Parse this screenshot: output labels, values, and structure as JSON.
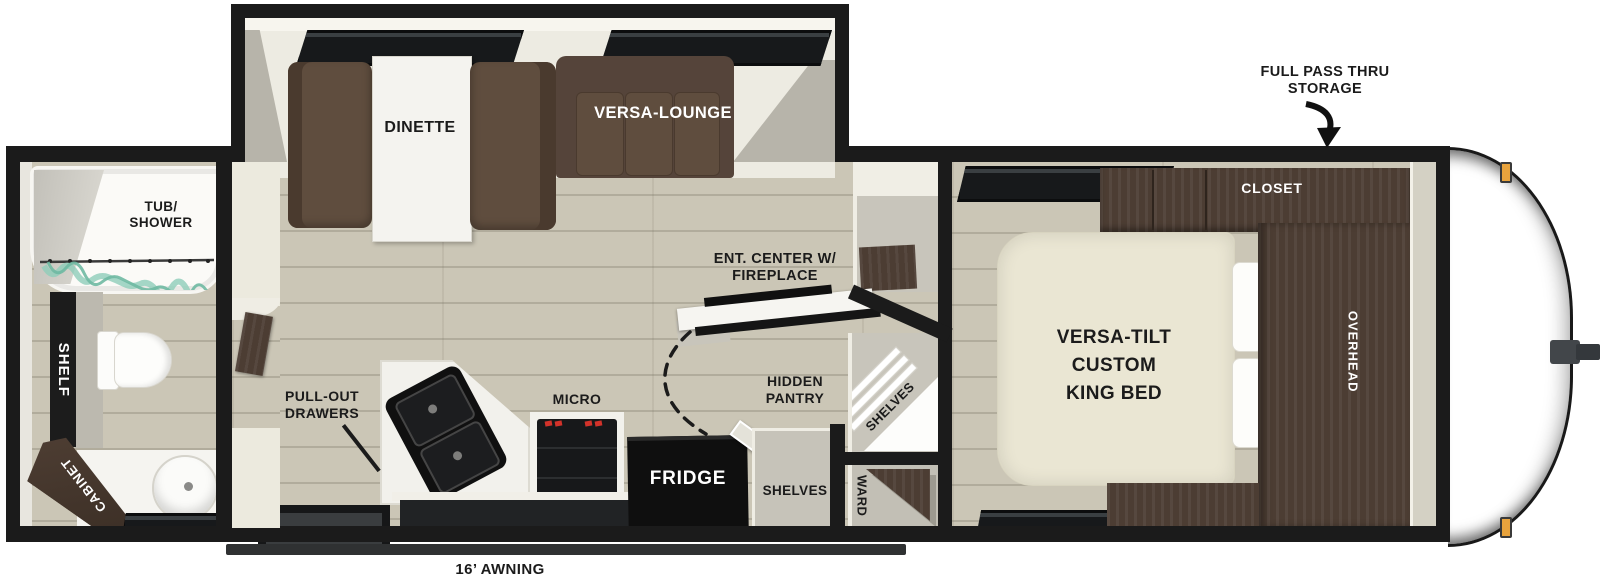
{
  "labels": {
    "tub_shower": "TUB/\nSHOWER",
    "shelf": "SHELF",
    "cabinet": "CABINET",
    "dinette": "DINETTE",
    "versa_lounge": "VERSA-LOUNGE",
    "ent_center": "ENT. CENTER W/\nFIREPLACE",
    "pull_out_drawers": "PULL-OUT\nDRAWERS",
    "micro": "MICRO",
    "fridge": "FRIDGE",
    "hidden_pantry": "HIDDEN\nPANTRY",
    "pantry_shelves": "SHELVES",
    "corner_shelves": "SHELVES",
    "wardrobe": "WARD",
    "bed": "VERSA-TILT\nCUSTOM\nKING BED",
    "closet": "CLOSET",
    "overhead": "OVERHEAD",
    "full_pass_thru": "FULL PASS THRU\nSTORAGE",
    "awning": "16’ AWNING"
  },
  "colors": {
    "wall": "#1b1b1b",
    "floor": "#cbc6b6",
    "slideout_floor": "#edebe2",
    "sofa_brown": "#5f4d3e",
    "cabinet_brown": "#4c3d33",
    "bed_cream": "#eae6d3",
    "appliance_black": "#161616",
    "marker_light_orange": "#e8a33d",
    "curtain_teal": "#8ecdb9",
    "burner_red": "#d2322a"
  }
}
